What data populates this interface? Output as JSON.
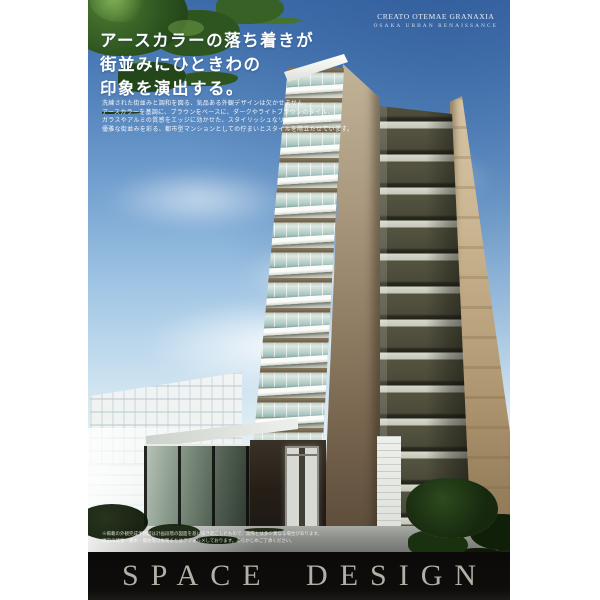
{
  "brand": {
    "name_line": "CREATO OTEMAE GRANAXIA",
    "tagline_line": "OSAKA URBAN RENAISSANCE"
  },
  "headline": {
    "line1": "アースカラーの落ち着きが",
    "line2": "街並みにひときわの",
    "line3": "印象を演出する。"
  },
  "body_copy": {
    "line1": "洗練された街並みと調和を図る、気品ある外観デザインは欠かせません。",
    "line2": "アースカラーを基調に、ブラウンをベースに、ダークやライトブラウンのタイル、",
    "line3": "ガラスやアルミの質感をエッジに効かせた、スタイリッシュなリジッドラインで、",
    "line4": "優雅な街並みを彩る、都市型マンションとしての佇まいとスタイルを際立たせています。"
  },
  "disclaimer": {
    "line1": "※掲載の外観完成予想図は計画段階の図面を基に描き起こしたもので、実際とは多少異なる場合があります。",
    "line2": "周辺の建物・樹木・電柱等は省略またはデフォルメしております。あらかじめご了承ください。"
  },
  "footer": {
    "title": "SPACE DESIGN"
  },
  "colors": {
    "sky_top": "#3e6cab",
    "sky_horizon": "#f1f6f6",
    "foliage_green": "#2e5520",
    "balcony_glass": "#adc8c2",
    "corner_wall_tan": "#8d7b62",
    "dark_tower_brick": "#53523f",
    "beige_building": "#c9b490",
    "footer_band": "#0e0d0b",
    "footer_text": "#b3afa6"
  }
}
